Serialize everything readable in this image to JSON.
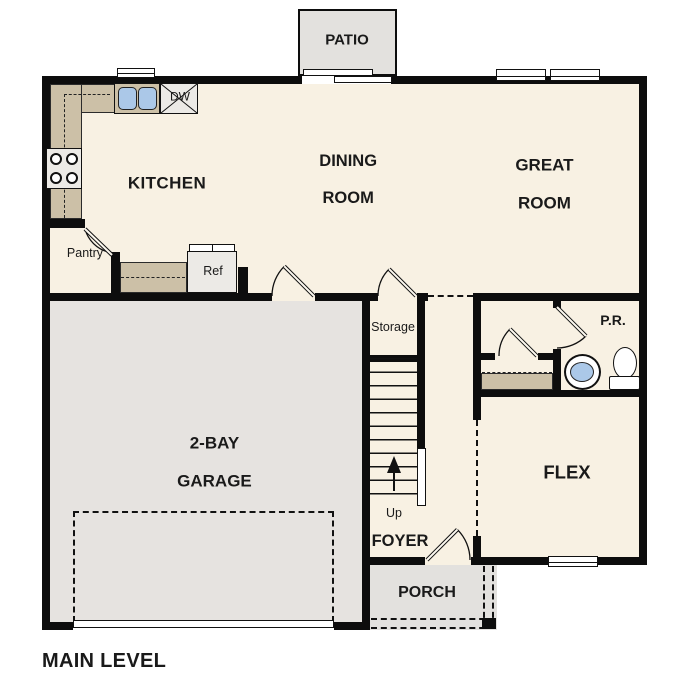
{
  "plan": {
    "title": "MAIN LEVEL",
    "rooms": {
      "patio": "PATIO",
      "kitchen": "KITCHEN",
      "dining_line1": "DINING",
      "dining_line2": "ROOM",
      "great_line1": "GREAT",
      "great_line2": "ROOM",
      "garage_line1": "2-BAY",
      "garage_line2": "GARAGE",
      "storage": "Storage",
      "powder_room": "P.R.",
      "flex": "FLEX",
      "foyer": "FOYER",
      "porch": "PORCH"
    },
    "fixtures": {
      "pantry": "Pantry",
      "dishwasher": "DW",
      "refrigerator": "Ref",
      "stairs_direction": "Up"
    },
    "colors": {
      "wall": "#0d0d0d",
      "floor": "#f8f1e3",
      "garage_floor": "#e6e3e0",
      "outdoor_floor": "#e3e1de",
      "counter": "#ccc0a7",
      "sink_blue": "#abc8e8"
    }
  }
}
